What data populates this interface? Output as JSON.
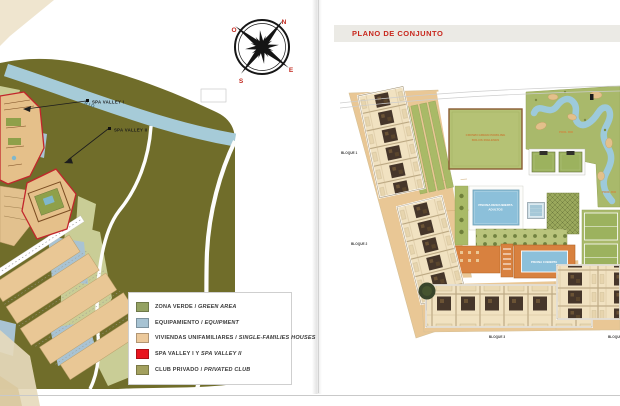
{
  "spread": {
    "left_page": {
      "compass": {
        "north": "N",
        "east": "E",
        "south": "S",
        "west": "O"
      },
      "map": {
        "river_label": "RIO",
        "callout_1": "SPA VALLEY I",
        "callout_2": "SPA VALLEY II"
      },
      "legend": {
        "items": [
          {
            "term": "ZONA VERDE",
            "separator": " / ",
            "translation": "GREEN AREA",
            "swatch_color": "#94a262"
          },
          {
            "term": "EQUIPAMIENTO",
            "separator": " / ",
            "translation": "EQUIPMENT",
            "swatch_color": "#a7c3d3"
          },
          {
            "term": "VIVIENDAS UNIFAMILIARES",
            "separator": " / ",
            "translation": "SINGLE-FAMILIES HOUSES",
            "swatch_color": "#ecc99b"
          },
          {
            "term": "SPA VALLEY I Y",
            "separator": " ",
            "translation": "SPA VALLEY II",
            "swatch_color": "#e9141e"
          },
          {
            "term": "CLUB PRIVADO",
            "separator": " / ",
            "translation": "PRIVATED CLUB",
            "swatch_color": "#a3a05e"
          }
        ]
      }
    },
    "right_page": {
      "header_title": "PLANO DE CONJUNTO",
      "plan": {
        "bloque_1": "BLOQUE 1",
        "bloque_2": "BLOQUE 2",
        "bloque_3": "BLOQUE 3",
        "bloque_4": "BLOQUE 4",
        "bowling_title": "CROWN GREEN BOWLING",
        "bowling_subtitle": "BOLOS INGLESES",
        "pool_rio_label_1": "POOL RIO",
        "pool_rio_label_2": "POOL RIO",
        "adult_pool_line_1": "PISCINA DESCUBIERTA",
        "adult_pool_line_2": "ADULTOS",
        "indoor_pool_label": "PISCINA CUBIERTA"
      }
    },
    "colors": {
      "accent_red": "#c8281e",
      "club_olive": "#706d2a",
      "river_blue": "#a6cbd8",
      "green_area": "#c9cd96",
      "equipment_blue": "#a9c3d3",
      "housing_tan": "#e9c795",
      "parcel_red": "#c2252b",
      "pool_blue": "#8cc0da",
      "lawn_green": "#a9ba67",
      "deck_orange": "#d8813f"
    }
  }
}
